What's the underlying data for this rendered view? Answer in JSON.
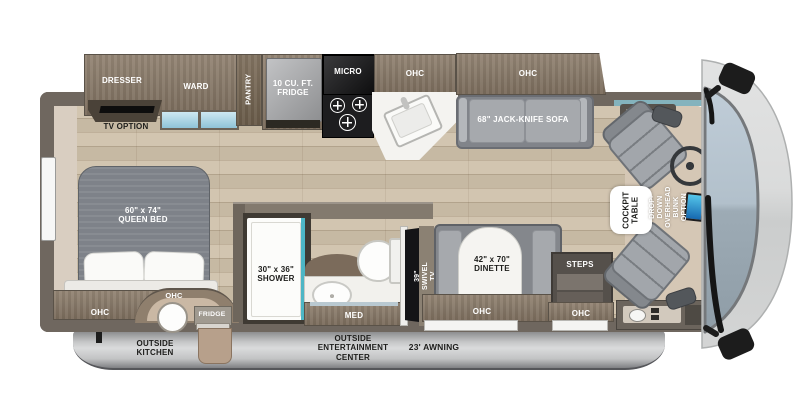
{
  "labels": {
    "dresser": "DRESSER",
    "tv_option": "TV OPTION",
    "ward": "WARD",
    "pantry": "PANTRY",
    "fridge10": "10 CU. FT.\nFRIDGE",
    "micro": "MICRO",
    "ohc": "OHC",
    "sofa": "68\" JACK-KNIFE SOFA",
    "queen_bed": "60\" x 74\"\nQUEEN BED",
    "outside_fridge": "FRIDGE",
    "outside_kitchen": "OUTSIDE\nKITCHEN",
    "shower": "30\" x 36\"\nSHOWER",
    "med": "MED",
    "swivel_tv": "39\" SWIVEL TV",
    "dinette": "42\" x 70\"\nDINETTE",
    "steps": "STEPS",
    "outside_entertainment": "OUTSIDE\nENTERTAINMENT\nCENTER",
    "awning": "23' AWNING",
    "cockpit_table": "COCKPIT\nTABLE",
    "bunk_option": "DROP-DOWN\nOVERHEAD BUNK\nOPTION"
  },
  "colors": {
    "floor_wood": "#cfc1aa",
    "cabinet_wood": "#8a7a68",
    "wall": "#6f675f",
    "shower_teal": "#4db6c5",
    "drawer_glass_blue": "#a9d2e2",
    "windshield_blue": "#aebfcc",
    "seat_gray": "#a2a6ab",
    "awning_gray": "#c6c7c8",
    "counter_white": "#f4f3f0",
    "appliance_black": "#141417"
  }
}
